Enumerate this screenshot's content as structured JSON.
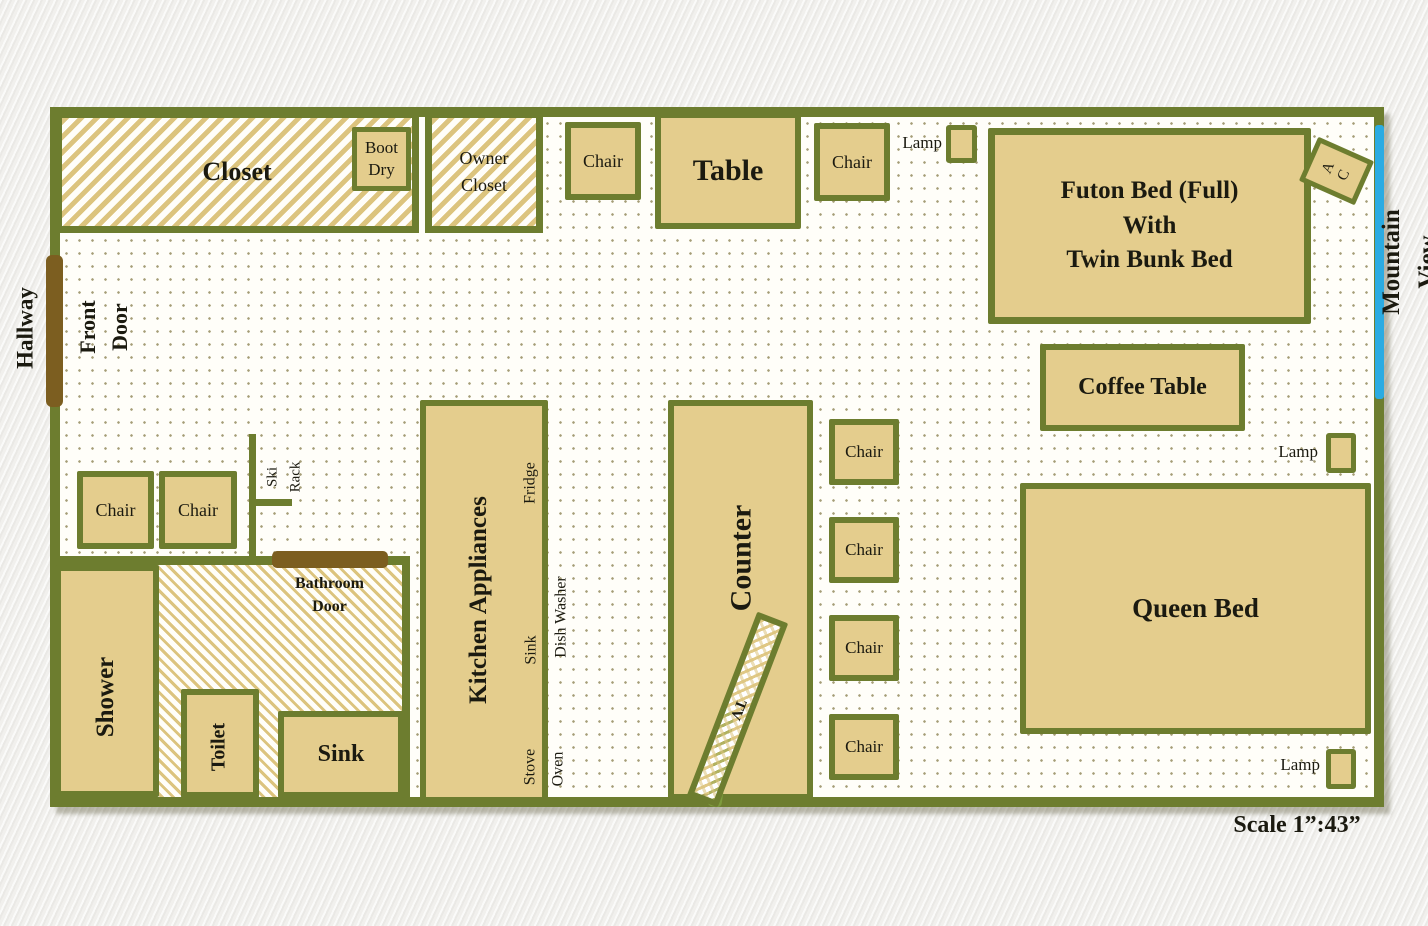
{
  "sides": {
    "hallway": "Hallway",
    "front_door": "Front\nDoor",
    "mountain_view": "Mountain View",
    "scale": "Scale 1”:43”"
  },
  "storage": {
    "closet": "Closet",
    "boot_dry": "Boot\nDry",
    "owner_closet": "Owner\nCloset",
    "ski_rack": "Ski\nRack"
  },
  "dining": {
    "table": "Table",
    "chair": "Chair",
    "lamp": "Lamp"
  },
  "sleeping": {
    "futon": "Futon Bed (Full)\nWith\nTwin Bunk Bed",
    "coffee_table": "Coffee Table",
    "queen_bed": "Queen Bed",
    "ac": "A\nC"
  },
  "kitchen": {
    "appliances": "Kitchen Appliances",
    "fridge": "Fridge",
    "sink": "Sink",
    "dish_washer": "Dish Washer",
    "stove": "Stove",
    "oven": "Oven",
    "counter": "Counter",
    "tv": "TV"
  },
  "bathroom": {
    "door": "Bathroom\nDoor",
    "shower": "Shower",
    "toilet": "Toilet",
    "sink": "Sink"
  },
  "colors": {
    "wall_olive": "#6d7d2f",
    "furniture_tan": "#e4cd8d",
    "hatch_tan": "#dcc47e",
    "door_brown": "#7c5e20",
    "window_blue": "#2babe2",
    "tv_stand_green": "#7d9b3d",
    "text": "#1b1a10"
  }
}
